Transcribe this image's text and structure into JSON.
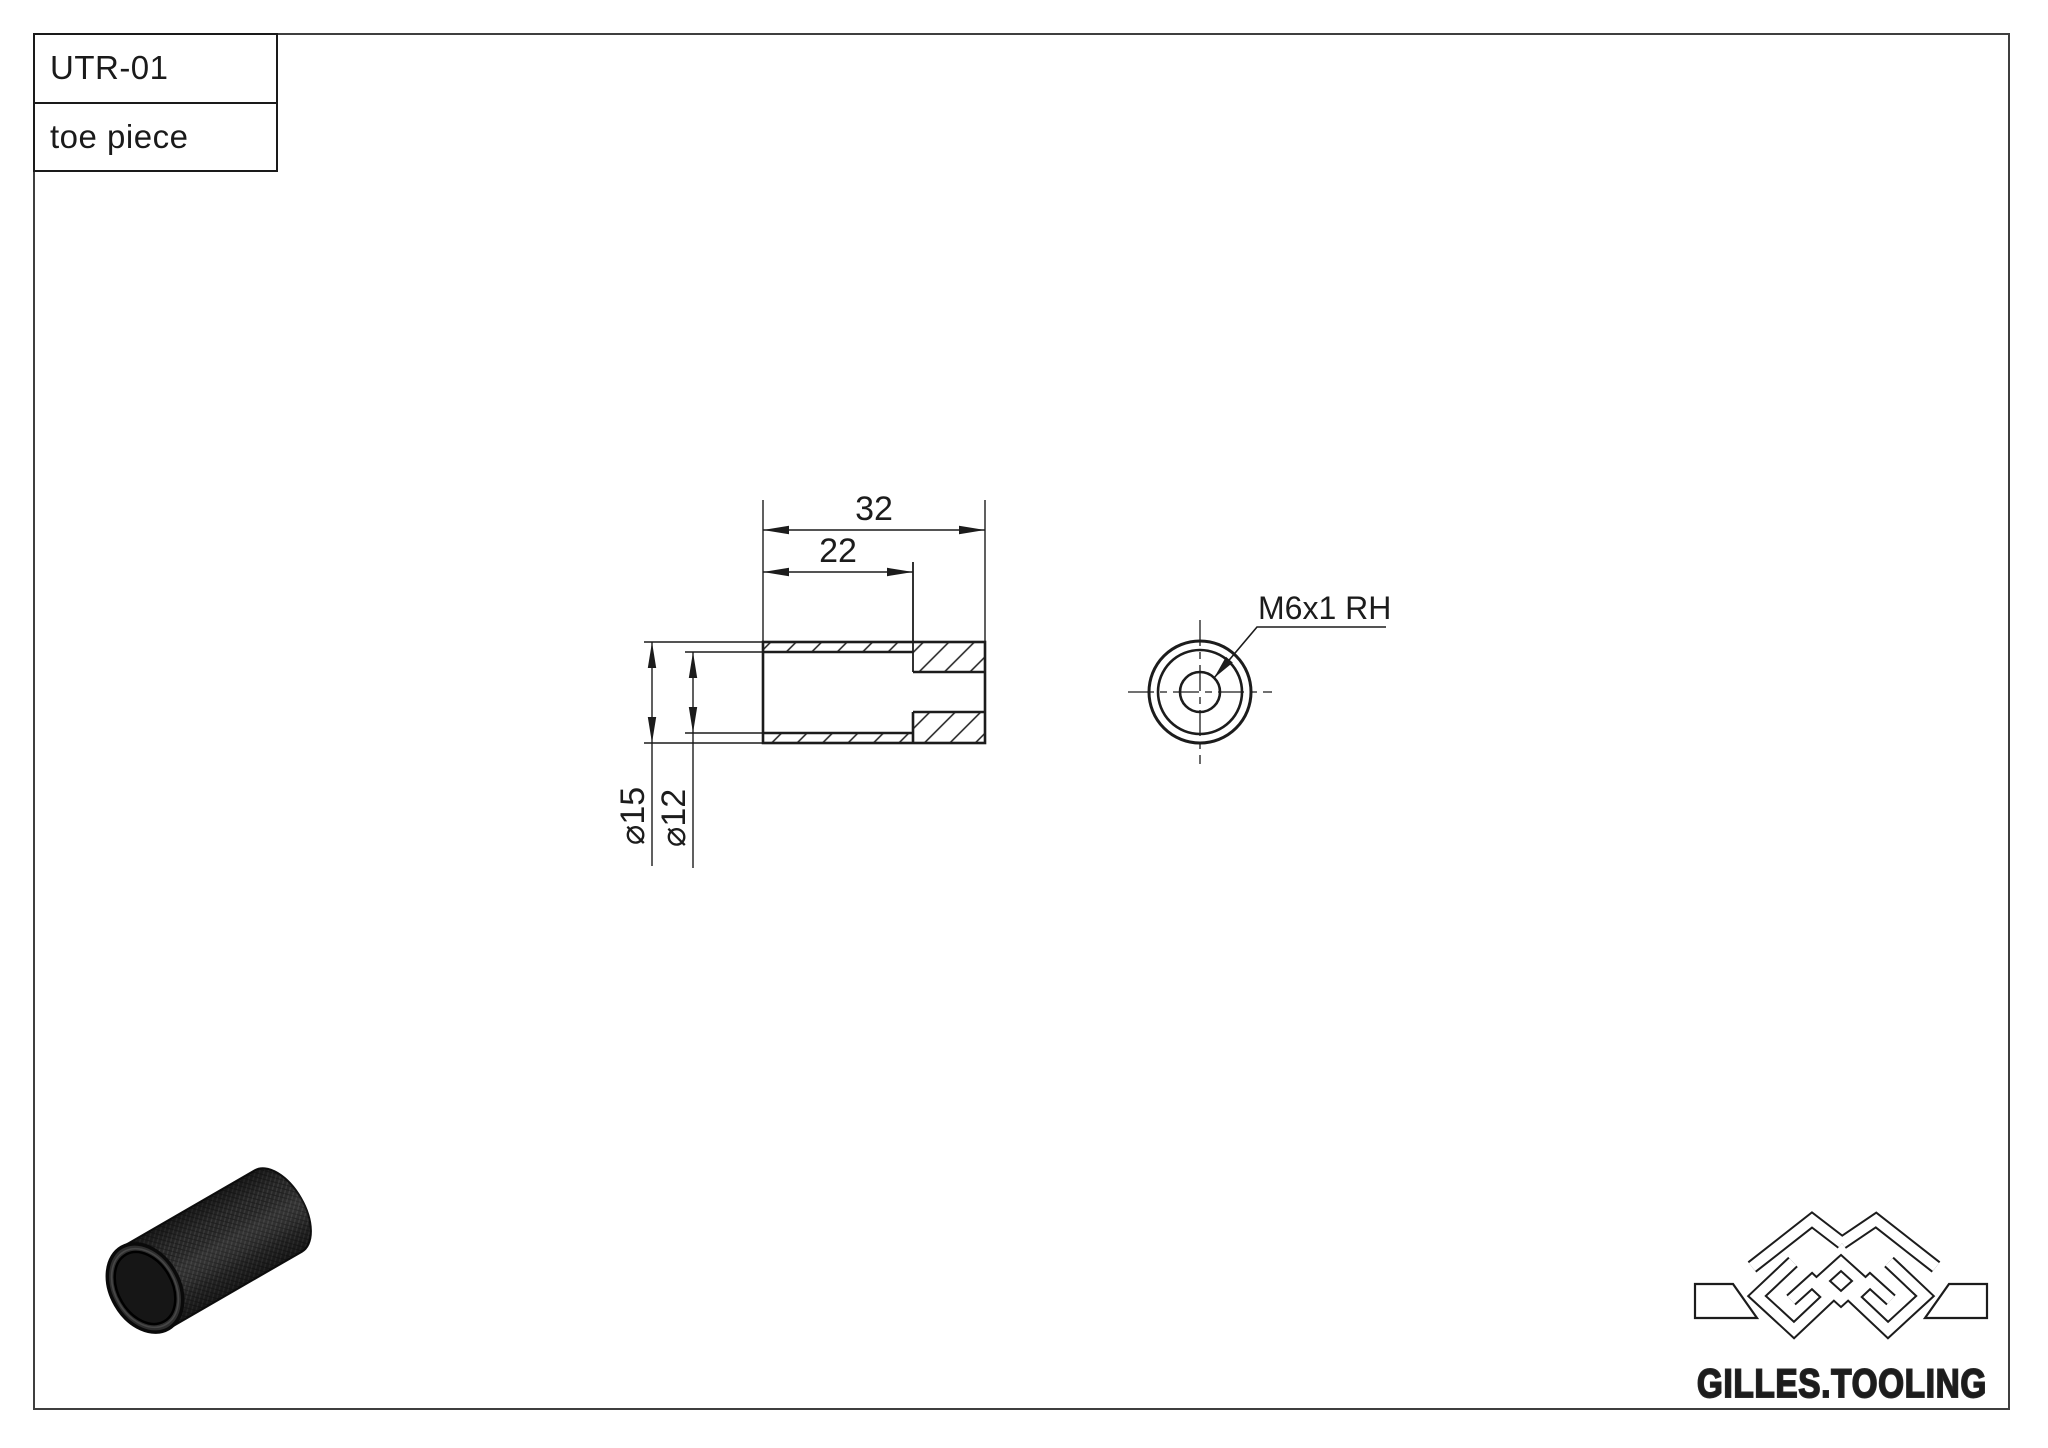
{
  "title_block": {
    "part_number": "UTR-01",
    "part_name": "toe piece"
  },
  "views": {
    "section_view": {
      "dim_total_length": "32",
      "dim_counterbore_depth": "22",
      "dim_outer_diameter": "⌀15",
      "dim_counterbore_diameter": "⌀12"
    },
    "end_view": {
      "thread_callout": "M6x1 RH"
    }
  },
  "branding": {
    "company": "GILLES.TOOLING"
  },
  "colors": {
    "line": "#1c1c1c",
    "frame": "#3f3f3f",
    "render_body": "#2a2a2a",
    "render_bore": "#161616"
  }
}
